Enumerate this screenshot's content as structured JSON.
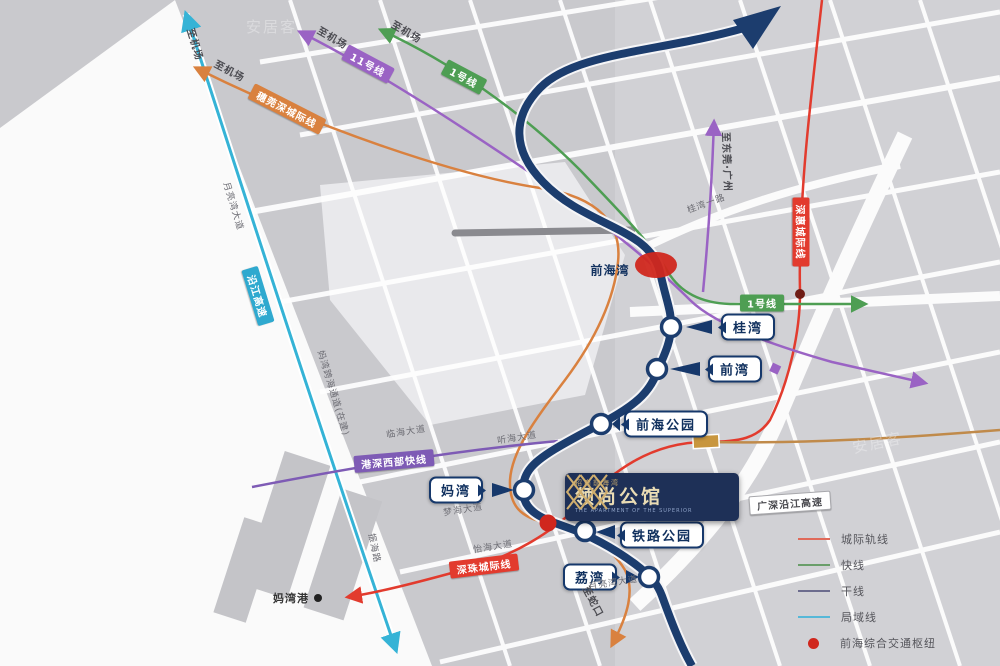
{
  "colors": {
    "main_line_navy": "#1c3d6e",
    "cyan_line": "#35b3d6",
    "orange_line": "#d9813f",
    "red_line": "#e23b2e",
    "green_line": "#4e9e53",
    "purple_line": "#9a63c4",
    "violet_line": "#7e5bb5",
    "tan_line": "#c08a4a",
    "hub_red": "#d0271d"
  },
  "logo": {
    "small": "招商前海湾",
    "name": "领尚公馆",
    "en": "THE APARTMENT OF THE SUPERIOR"
  },
  "stations": [
    {
      "label": "桂湾",
      "x": 748,
      "y": 327,
      "pointer": "left"
    },
    {
      "label": "前湾",
      "x": 735,
      "y": 369,
      "pointer": "left"
    },
    {
      "label": "前海公园",
      "x": 666,
      "y": 424,
      "pointer": "left"
    },
    {
      "label": "妈湾",
      "x": 456,
      "y": 490,
      "pointer": "right"
    },
    {
      "label": "铁路公园",
      "x": 662,
      "y": 535,
      "pointer": "left"
    },
    {
      "label": "荔湾",
      "x": 590,
      "y": 577,
      "pointer": "right"
    }
  ],
  "plain_labels": [
    {
      "label": "前海湾",
      "x": 610,
      "y": 270
    },
    {
      "label": "妈湾港",
      "x": 291,
      "y": 598,
      "fs": 11,
      "color": "#333333"
    }
  ],
  "line_badges": [
    {
      "label": "11号线",
      "x": 368,
      "y": 64,
      "rot": 28,
      "bg": "#9a63c4"
    },
    {
      "label": "1号线",
      "x": 464,
      "y": 77,
      "rot": 28,
      "bg": "#4e9e53"
    },
    {
      "label": "穗莞深城际线",
      "x": 287,
      "y": 109,
      "rot": 27,
      "bg": "#d9813f"
    },
    {
      "label": "深惠城际线",
      "x": 801,
      "y": 232,
      "rot": 90,
      "bg": "#e23b2e"
    },
    {
      "label": "1号线",
      "x": 762,
      "y": 303,
      "rot": 0,
      "bg": "#4e9e53"
    },
    {
      "label": "港深西部快线",
      "x": 394,
      "y": 461,
      "rot": -5,
      "bg": "#7e5bb5"
    },
    {
      "label": "沿江高速",
      "x": 258,
      "y": 296,
      "rot": 73,
      "bg": "#2fa9cf"
    },
    {
      "label": "深珠城际线",
      "x": 484,
      "y": 566,
      "rot": -7,
      "bg": "#e23b2e"
    },
    {
      "label": "广深沿江高速",
      "x": 790,
      "y": 503,
      "rot": -4,
      "bg": "#ffffff",
      "color": "#4a4a4f",
      "border": "1px solid #a8a8ac"
    }
  ],
  "direction_labels": [
    {
      "label": "至机场",
      "x": 333,
      "y": 37,
      "rot": 30
    },
    {
      "label": "至机场",
      "x": 407,
      "y": 31,
      "rot": 30
    },
    {
      "label": "至机场",
      "x": 230,
      "y": 70,
      "rot": 28
    },
    {
      "label": "至机场",
      "x": 196,
      "y": 44,
      "rot": 73
    },
    {
      "label": "至东莞·广州",
      "x": 728,
      "y": 162,
      "rot": 88
    },
    {
      "label": "至蛇口",
      "x": 594,
      "y": 601,
      "rot": 62
    }
  ],
  "road_labels": [
    {
      "label": "临海大道",
      "x": 406,
      "y": 431,
      "rot": -9
    },
    {
      "label": "听海大道",
      "x": 517,
      "y": 437,
      "rot": -9
    },
    {
      "label": "梦海大道",
      "x": 463,
      "y": 509,
      "rot": -9
    },
    {
      "label": "怡海大道",
      "x": 493,
      "y": 546,
      "rot": -9
    },
    {
      "label": "月亮湾大道",
      "x": 613,
      "y": 582,
      "rot": -9
    },
    {
      "label": "振海路",
      "x": 375,
      "y": 548,
      "rot": 78
    },
    {
      "label": "月亮湾大道",
      "x": 234,
      "y": 206,
      "rot": 73
    },
    {
      "label": "桂湾一路",
      "x": 706,
      "y": 203,
      "rot": -20
    },
    {
      "label": "妈湾跨海通道(在建)",
      "x": 334,
      "y": 393,
      "rot": 73
    }
  ],
  "legend": {
    "items": [
      {
        "type": "line",
        "color": "#e06a5a",
        "label": "城际轨线"
      },
      {
        "type": "line",
        "color": "#6a9e6a",
        "label": "快线"
      },
      {
        "type": "line",
        "color": "#6c6c8e",
        "label": "干线"
      },
      {
        "type": "line",
        "color": "#56b8d8",
        "label": "局域线"
      },
      {
        "type": "dot",
        "color": "#d0271d",
        "label": "前海综合交通枢纽"
      }
    ]
  },
  "watermark": {
    "text": "安居客"
  }
}
